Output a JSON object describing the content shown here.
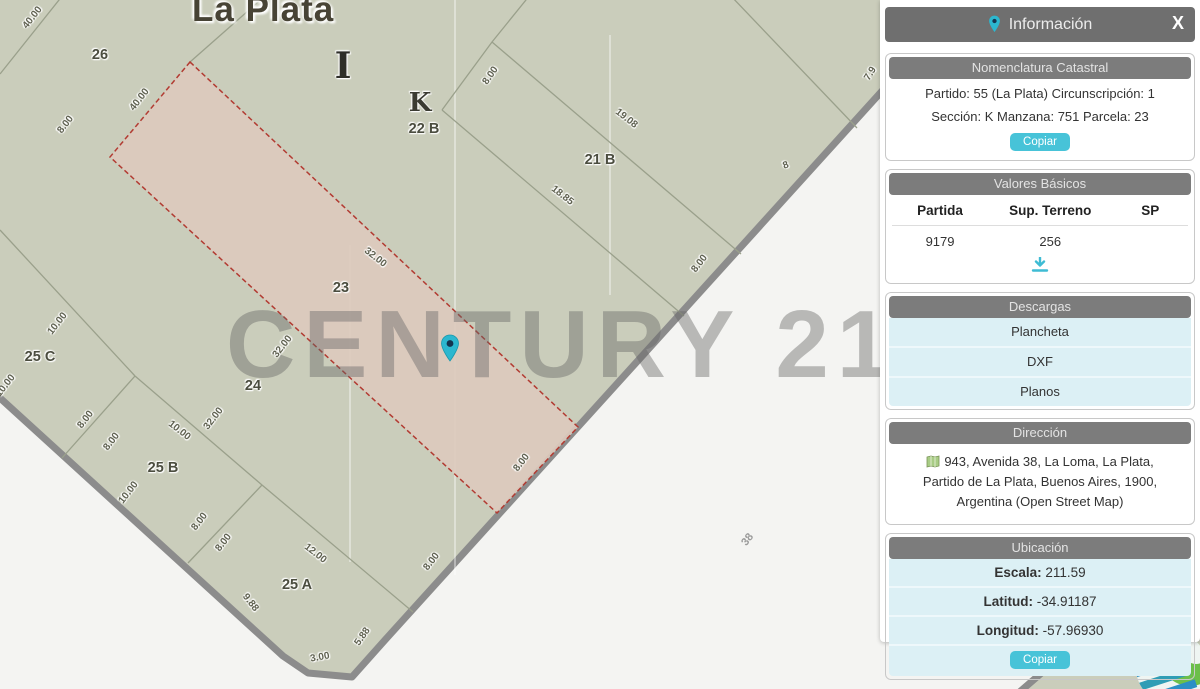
{
  "map": {
    "title": "La Plata",
    "watermark": "CENTURY 21",
    "watermark_reg": "®",
    "colors": {
      "block_fill": "#cacdbb",
      "street_fill": "#f4f4f2",
      "road_edge": "#8c8c8c",
      "parcel_line": "#9aa08b",
      "highlight_fill": "#dccabd",
      "highlight_border": "#b23b32",
      "marker_teal": "#2cb7cf",
      "panel_header_gray": "#6f6f6f",
      "section_header_gray": "#7c7c7c",
      "button_teal": "#47c3d8",
      "light_blue": "#dcf0f5"
    },
    "labels": [
      {
        "t": "40.00",
        "x": 33,
        "y": 18,
        "r": -52
      },
      {
        "t": "26",
        "x": 100,
        "y": 55,
        "r": 0,
        "k": "parcel"
      },
      {
        "t": "40.00",
        "x": 140,
        "y": 100,
        "r": -52
      },
      {
        "t": "8.00",
        "x": 66,
        "y": 125,
        "r": -52
      },
      {
        "t": "I",
        "x": 343,
        "y": 66,
        "r": 0,
        "k": "letterbig"
      },
      {
        "t": "K",
        "x": 420,
        "y": 103,
        "r": 0,
        "k": "letter"
      },
      {
        "t": "22 B",
        "x": 424,
        "y": 129,
        "r": 0,
        "k": "parcel"
      },
      {
        "t": "8.00",
        "x": 491,
        "y": 76,
        "r": -55
      },
      {
        "t": "19.08",
        "x": 626,
        "y": 119,
        "r": 38
      },
      {
        "t": "21 B",
        "x": 600,
        "y": 160,
        "r": 0,
        "k": "parcel"
      },
      {
        "t": "18.85",
        "x": 562,
        "y": 196,
        "r": 38
      },
      {
        "t": "8",
        "x": 786,
        "y": 166,
        "r": -20
      },
      {
        "t": "7.9",
        "x": 871,
        "y": 74,
        "r": -58
      },
      {
        "t": "8.00",
        "x": 700,
        "y": 264,
        "r": -52
      },
      {
        "t": "23",
        "x": 341,
        "y": 288,
        "r": 0,
        "k": "parcel"
      },
      {
        "t": "32.00",
        "x": 375,
        "y": 258,
        "r": 38
      },
      {
        "t": "32.00",
        "x": 283,
        "y": 347,
        "r": -52
      },
      {
        "t": "24",
        "x": 253,
        "y": 386,
        "r": 0,
        "k": "parcel"
      },
      {
        "t": "32.00",
        "x": 214,
        "y": 419,
        "r": -52
      },
      {
        "t": "25 C",
        "x": 40,
        "y": 357,
        "r": 0,
        "k": "parcel"
      },
      {
        "t": "10.00",
        "x": 58,
        "y": 324,
        "r": -52
      },
      {
        "t": "10.00",
        "x": 6,
        "y": 386,
        "r": -52
      },
      {
        "t": "8.00",
        "x": 86,
        "y": 420,
        "r": -52
      },
      {
        "t": "8.00",
        "x": 112,
        "y": 442,
        "r": -52
      },
      {
        "t": "10.00",
        "x": 179,
        "y": 431,
        "r": 38
      },
      {
        "t": "25 B",
        "x": 163,
        "y": 468,
        "r": 0,
        "k": "parcel"
      },
      {
        "t": "10.00",
        "x": 129,
        "y": 493,
        "r": -52
      },
      {
        "t": "12.00",
        "x": 315,
        "y": 554,
        "r": 38
      },
      {
        "t": "8.00",
        "x": 200,
        "y": 522,
        "r": -52
      },
      {
        "t": "8.00",
        "x": 224,
        "y": 543,
        "r": -52
      },
      {
        "t": "25 A",
        "x": 297,
        "y": 585,
        "r": 0,
        "k": "parcel"
      },
      {
        "t": "9.88",
        "x": 250,
        "y": 603,
        "r": 52
      },
      {
        "t": "3.00",
        "x": 320,
        "y": 658,
        "r": -10
      },
      {
        "t": "5.88",
        "x": 363,
        "y": 637,
        "r": -55
      },
      {
        "t": "8.00",
        "x": 432,
        "y": 562,
        "r": -52
      },
      {
        "t": "8.00",
        "x": 522,
        "y": 463,
        "r": -52
      },
      {
        "t": "38",
        "x": 748,
        "y": 540,
        "r": -52,
        "k": "street"
      },
      {
        "t": "8.66",
        "x": 1036,
        "y": 660,
        "r": -48
      }
    ]
  },
  "panel": {
    "header": {
      "title": "Información",
      "close_label": "X"
    },
    "nomenclatura": {
      "title": "Nomenclatura Catastral",
      "lines": [
        "Partido: 55 (La Plata) Circunscripción: 1",
        "Sección: K Manzana: 751 Parcela: 23"
      ],
      "copy_label": "Copiar"
    },
    "valores": {
      "title": "Valores Básicos",
      "headers": [
        "Partida",
        "Sup. Terreno",
        "SP"
      ],
      "row": [
        "9179",
        "256",
        ""
      ]
    },
    "descargas": {
      "title": "Descargas",
      "links": [
        "Plancheta",
        "DXF",
        "Planos"
      ]
    },
    "direccion": {
      "title": "Dirección",
      "lines": [
        "943, Avenida 38, La Loma, La Plata,",
        "Partido de La Plata, Buenos Aires, 1900,",
        "Argentina (Open Street Map)"
      ]
    },
    "ubicacion": {
      "title": "Ubicación",
      "rows": [
        {
          "label": "Escala:",
          "value": "211.59"
        },
        {
          "label": "Latitud:",
          "value": "-34.91187"
        },
        {
          "label": "Longitud:",
          "value": "-57.96930"
        }
      ],
      "copy_label": "Copiar"
    }
  }
}
